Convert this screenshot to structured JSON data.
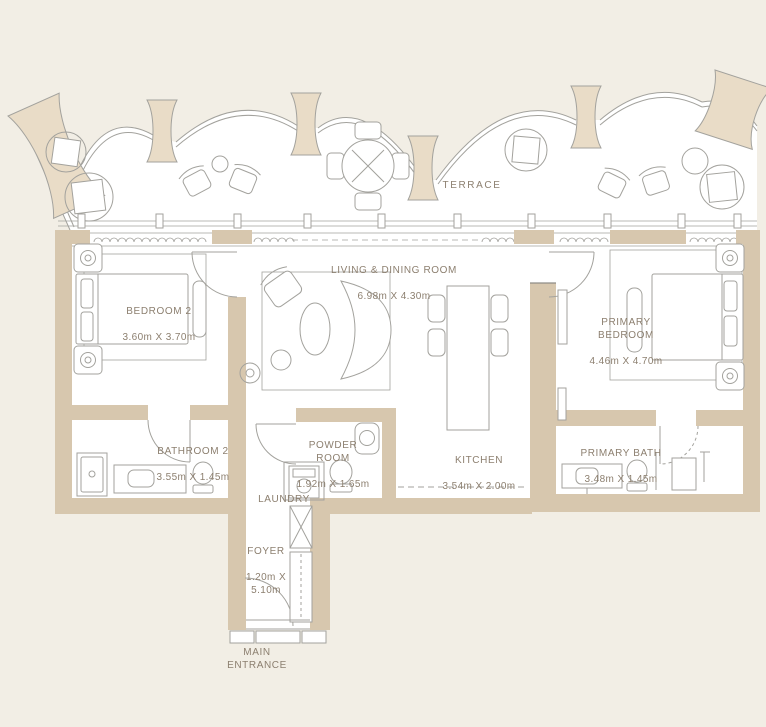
{
  "colors": {
    "background": "#F2EEE5",
    "wall": "#D7C7AE",
    "fin": "#E9DCC7",
    "floor": "#FFFFFF",
    "line": "#A3A29D",
    "text": "#8C7F6F"
  },
  "terrace": {
    "label": "TERRACE"
  },
  "rooms": [
    {
      "id": "living-dining",
      "name": "LIVING & DINING ROOM",
      "dims": "6.98m X 4.30m"
    },
    {
      "id": "bedroom-2",
      "name": "BEDROOM 2",
      "dims": "3.60m X 3.70m"
    },
    {
      "id": "primary-bedroom",
      "name": "PRIMARY\nBEDROOM",
      "dims": "4.46m X 4.70m"
    },
    {
      "id": "bathroom-2",
      "name": "BATHROOM 2",
      "dims": "3.55m X 1.45m"
    },
    {
      "id": "powder-room",
      "name": "POWDER\nROOM",
      "dims": "1.92m X 1.65m"
    },
    {
      "id": "kitchen",
      "name": "KITCHEN",
      "dims": "3.54m X 2.00m"
    },
    {
      "id": "primary-bath",
      "name": "PRIMARY BATH",
      "dims": "3.48m X 1.45m"
    },
    {
      "id": "laundry",
      "name": "LAUNDRY",
      "dims": ""
    },
    {
      "id": "foyer",
      "name": "FOYER",
      "dims": "1.20m X\n5.10m"
    }
  ],
  "entrance": {
    "label": "MAIN\nENTRANCE"
  }
}
